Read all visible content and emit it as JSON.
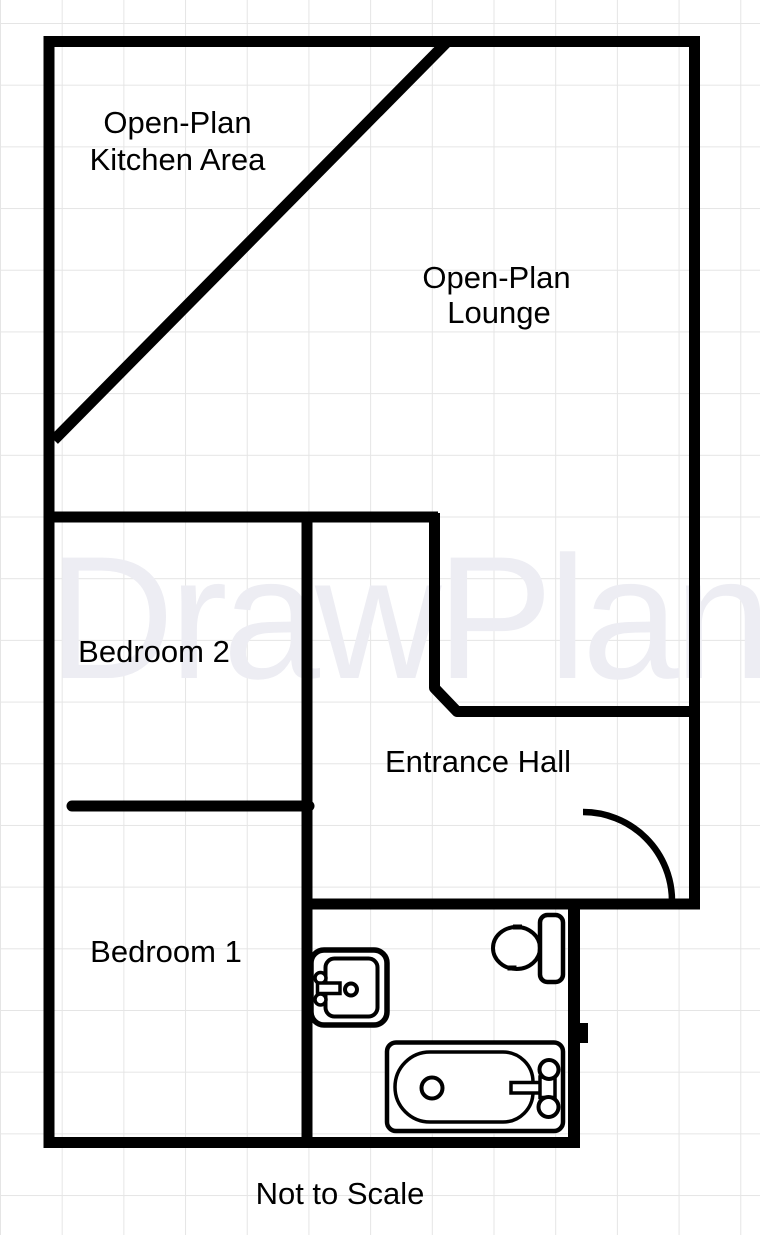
{
  "plan": {
    "watermark": "DrawPlan",
    "rooms": {
      "kitchen": {
        "line1": "Open-Plan",
        "line2": "Kitchen Area"
      },
      "lounge": {
        "line1": "Open-Plan",
        "line2": "Lounge"
      },
      "bedroom2": {
        "label": "Bedroom 2"
      },
      "entrance": {
        "label": "Entrance Hall"
      },
      "bedroom1": {
        "label": "Bedroom 1"
      }
    },
    "footer": {
      "note": "Not to Scale"
    },
    "fixtures": {
      "sink": "sink-icon",
      "toilet": "toilet-icon",
      "bath": "bathtub-icon",
      "door": "entrance-door-swing-icon"
    },
    "colors": {
      "wall": "#000000",
      "ink": "#000000",
      "watermark": "#EDEDF3",
      "grid": "#E5E5E5",
      "background": "#FFFFFF"
    }
  }
}
